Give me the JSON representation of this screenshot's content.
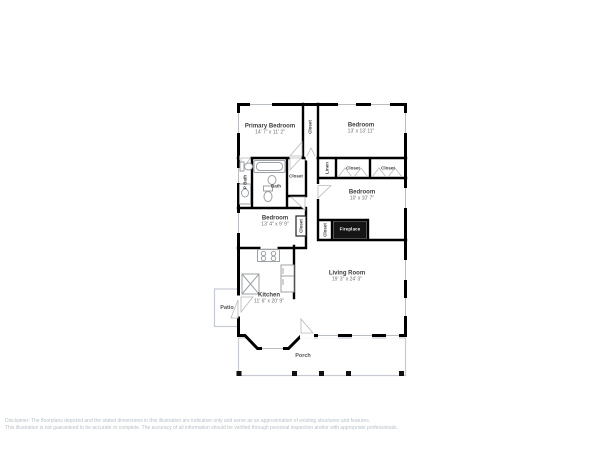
{
  "rooms": {
    "primary_bedroom": {
      "name": "Primary Bedroom",
      "dims": "14' 7\" x 11' 2\""
    },
    "bedroom_top_right": {
      "name": "Bedroom",
      "dims": "13' x 13' 11\""
    },
    "bedroom_right": {
      "name": "Bedroom",
      "dims": "10' x 10' 7\""
    },
    "bedroom_left": {
      "name": "Bedroom",
      "dims": "13' 4\" x 9' 9\""
    },
    "kitchen": {
      "name": "Kitchen",
      "dims": "11' 6\" x 20' 9\""
    },
    "living_room": {
      "name": "Living Room",
      "dims": "19' 3\" x 24' 3\""
    }
  },
  "labels": {
    "closet": "Closet",
    "linen": "Linen",
    "p_bath": "P Bath",
    "bath": "Bath",
    "fireplace": "Fireplace"
  },
  "areas": {
    "patio": "Patio",
    "porch": "Porch"
  },
  "disclaimer": {
    "line1": "Disclaimer: The floorplans depicted and the stated dimensions in this illustration are indicative only and serve as an approximation of existing structures and features.",
    "line2": "This illustration is not guaranteed to be accurate or complete. The accuracy of all information should be verified through personal inspection and/or with appropriate professionals."
  },
  "colors": {
    "walls": "#000000",
    "fixtures": "#9ca1a6",
    "deck_outline": "#c6cbd1",
    "room_text": "#3d3d3d",
    "dim_text": "#6e6e6e",
    "disclaimer_text": "#b8c0c7",
    "fireplace_fill": "#151515",
    "fireplace_text": "#ffffff"
  }
}
